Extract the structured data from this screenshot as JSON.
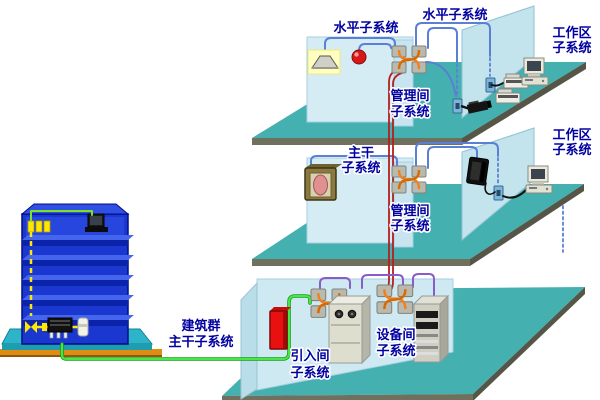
{
  "labels": {
    "horizontal1": "水平子系统",
    "horizontal2": "水平子系统",
    "workarea1_line1": "工作区",
    "workarea1_line2": "子系统",
    "workarea2_line1": "工作区",
    "workarea2_line2": "子系统",
    "management1_line1": "管理间",
    "management1_line2": "子系统",
    "management2_line1": "管理间",
    "management2_line2": "子系统",
    "backbone_line1": "主干",
    "backbone_line2": "子系统",
    "campus_line1": "建筑群",
    "campus_line2": "主干子系统",
    "entrance_line1": "引入间",
    "entrance_line2": "子系统",
    "equipment_line1": "设备间",
    "equipment_line2": "子系统"
  },
  "colors": {
    "label_text": "#0000a0",
    "floor_slab": "#44b0b0",
    "slab_front_edge": "#70705e",
    "slab_side_edge": "#565648",
    "wall": "#d5ecf5",
    "wall_strip": "#c8e5ef",
    "partition": "#c3e4ec",
    "side_wall": "#b9dde9",
    "horizontal_cable": "#5b7fd4",
    "backbone_cable": "#b32020",
    "campus_cable": "#46e846",
    "equipment_cable": "#8a5cc8",
    "crossconnect_cable": "#f08020",
    "building_body": "#1a38d0",
    "building_slab_top": "#4565ee",
    "building_slab_front": "#0b23a8",
    "building_base": "#2db4c8",
    "ground": "#dd8d12",
    "riser_cable": "#ffe800",
    "protector": "#e81010"
  },
  "icons": {
    "building": "office-building-icon",
    "lamp": "ceiling-lamp-icon",
    "fire_alarm": "fire-alarm-bell-icon",
    "patch_panel": "patch-panel-icon",
    "camera": "security-camera-icon",
    "computer": "desktop-computer-icon",
    "printer": "printer-icon",
    "speaker": "wall-speaker-icon",
    "phone": "wall-phone-icon",
    "outlet": "network-outlet-icon",
    "pbx": "pbx-cabinet-icon",
    "server_rack": "server-rack-icon",
    "protector": "entrance-protector-icon"
  }
}
